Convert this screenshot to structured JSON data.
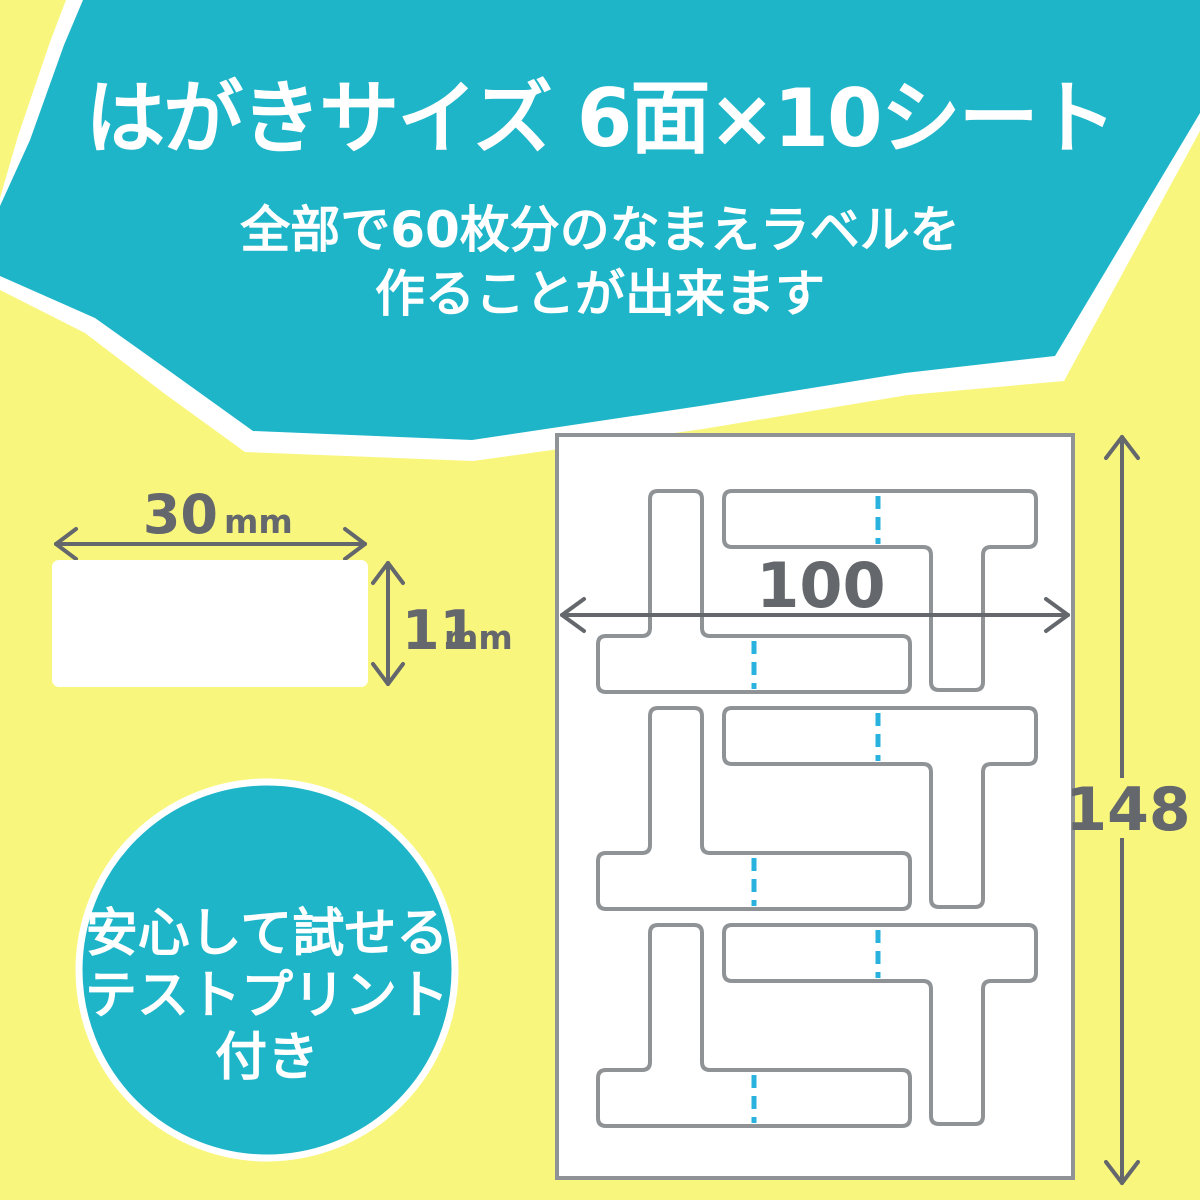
{
  "banner": {
    "title": "はがきサイズ 6面×10シート",
    "subtitle_line1": "全部で60枚分のなまえラベルを",
    "subtitle_line2": "作ることが出来ます"
  },
  "label_diagram": {
    "width_value": "30",
    "width_unit": "mm",
    "height_value": "11",
    "height_unit": "mm"
  },
  "sheet_diagram": {
    "width_label": "100",
    "height_label": "148"
  },
  "badge": {
    "line1": "安心して試せる",
    "line2": "テストプリント",
    "line3": "付き"
  },
  "colors": {
    "teal": "#1fb5c9",
    "yellow": "#f9f67d",
    "perforation_cyan": "#29b2de",
    "dimension_gray": "#64676b",
    "outline_gray": "#909396",
    "white": "#ffffff"
  }
}
